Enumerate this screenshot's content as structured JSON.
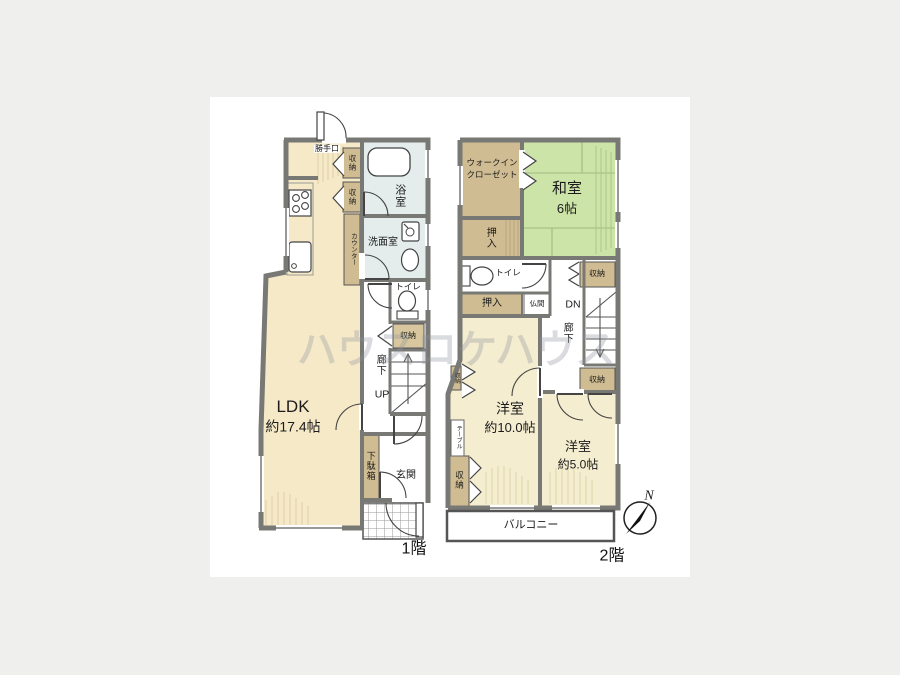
{
  "watermark": {
    "text": "ハウスロケハウス"
  },
  "compass": {
    "north": "N"
  },
  "colors": {
    "floor_cream": "#f6e9c8",
    "room_cream": "#f5edd0",
    "tatami_green": "#cde4a9",
    "closet_tan": "#d0bc92",
    "wet_blue": "#e4ecec",
    "wall_gray": "#787874"
  },
  "floor1": {
    "title": "1階",
    "ldk": {
      "name": "LDK",
      "size": "約17.4帖"
    },
    "labels": {
      "katteguchi": "勝手口",
      "storage_a": "収納",
      "storage_b": "収納",
      "counter": "カウンター",
      "bath": "浴室",
      "washroom": "洗面室",
      "toilet": "トイレ",
      "storage_hall": "収納",
      "hallway": "廊下",
      "up": "UP",
      "shoe_cabinet": "下駄箱",
      "entrance": "玄関"
    }
  },
  "floor2": {
    "title": "2階",
    "washitsu": {
      "name": "和室",
      "size": "6帖"
    },
    "yoshitsu10": {
      "name": "洋室",
      "size": "約10.0帖"
    },
    "yoshitsu5": {
      "name": "洋室",
      "size": "約5.0帖"
    },
    "labels": {
      "wic_line1": "ウォークイン",
      "wic_line2": "クローゼット",
      "oshiire_top": "押入",
      "toilet": "トイレ",
      "storage_ne": "収納",
      "oshiire_mid": "押入",
      "butsuma": "仏間",
      "dn": "DN",
      "hallway": "廊下",
      "storage_e": "収納",
      "storage_diag": "収納",
      "table": "テーブル",
      "storage_sw": "収納",
      "balcony": "バルコニー"
    }
  }
}
